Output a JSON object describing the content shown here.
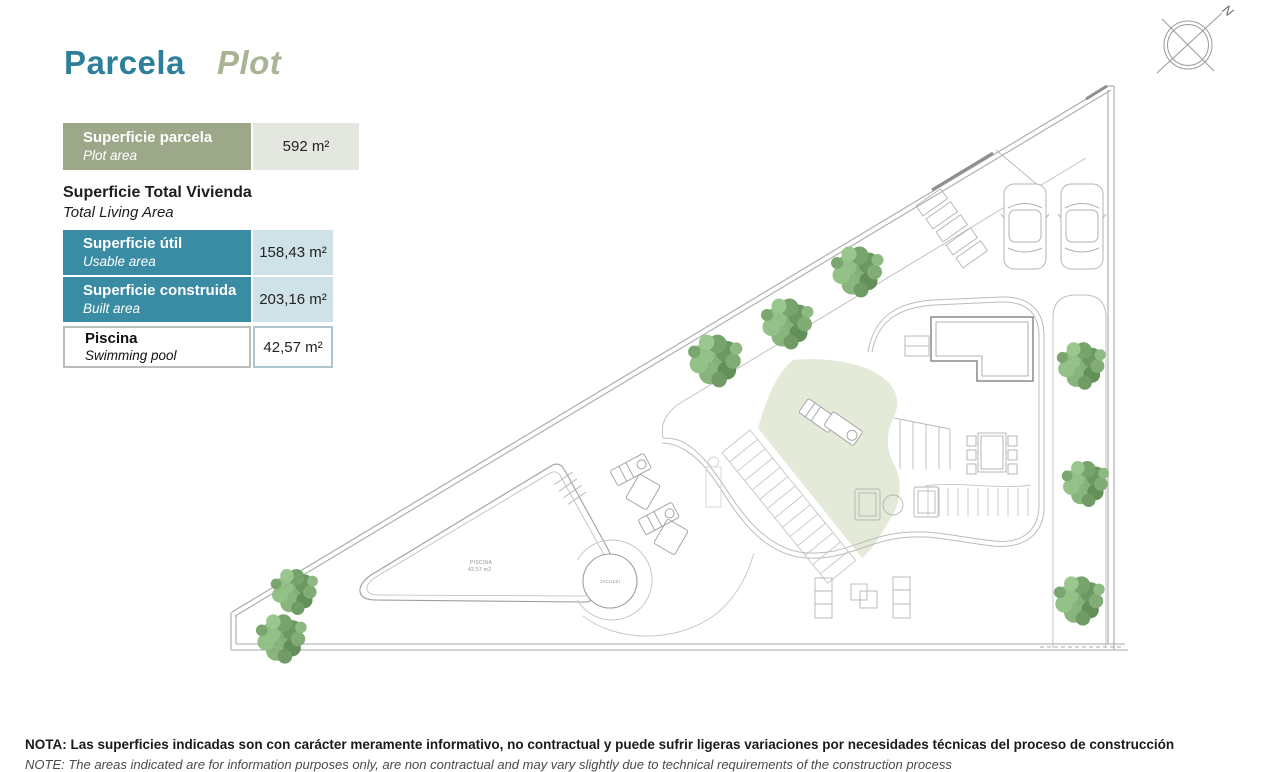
{
  "title": {
    "main": "Parcela",
    "sub": "Plot"
  },
  "legend": {
    "plot_row": {
      "label": "Superficie parcela",
      "sublabel": "Plot area",
      "value": "592 m²"
    },
    "section": {
      "title": "Superficie Total Vivienda",
      "subtitle": "Total Living Area"
    },
    "usable_row": {
      "label": "Superficie útil",
      "sublabel": "Usable area",
      "value": "158,43 m²"
    },
    "built_row": {
      "label": "Superficie construida",
      "sublabel": "Built area",
      "value": "203,16 m²"
    },
    "pool_row": {
      "label": "Piscina",
      "sublabel": "Swimming pool",
      "value": "42,57 m²"
    }
  },
  "plan": {
    "compass_label": "N",
    "pool_label_line1": "PISCINA",
    "pool_label_line2": "42,57 m2",
    "jacuzzi_label": "JACUZZI"
  },
  "note": {
    "line1_es": "NOTA: Las superficies indicadas son con carácter meramente informativo, no contractual y puede sufrir ligeras variaciones por necesidades técnicas del proceso de construcción",
    "line2_en": "NOTE: The areas indicated are for information purposes only, are non contractual and may vary slightly due to technical requirements of the construction process"
  },
  "colors": {
    "title_teal": "#2d7f9b",
    "title_sage": "#a9b494",
    "row_sage_bg": "#9ca889",
    "row_sage_value_bg": "#e4e6e0",
    "row_teal_bg": "#3a8ba4",
    "row_teal_value_bg": "#cfe2e8",
    "lawn_green": "#e3ead8",
    "plan_line": "#b9b9b9",
    "tree_green": "#79a96c"
  }
}
